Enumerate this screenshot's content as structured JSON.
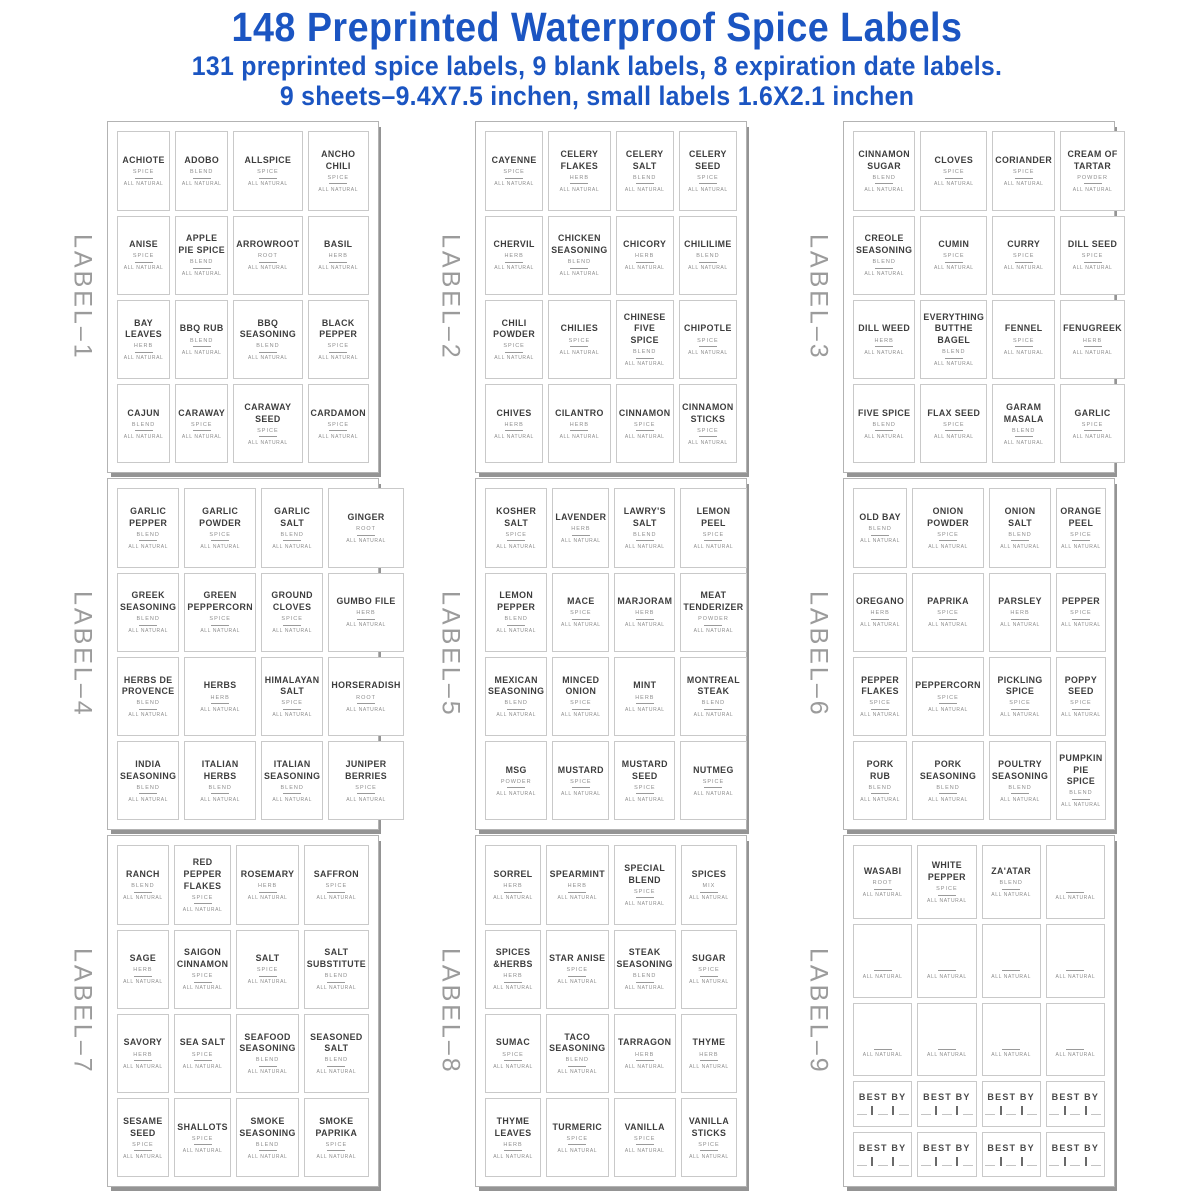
{
  "header": {
    "title": "148 Preprinted Waterproof Spice Labels",
    "subtitle1": "131 preprinted spice labels, 9 blank labels, 8 expiration date labels.",
    "subtitle2": "9 sheets–9.4X7.5 inchen, small labels 1.6X2.1 inchen"
  },
  "strings": {
    "all_natural": "ALL NATURAL",
    "best_by": "BEST BY"
  },
  "colors": {
    "accent_blue": "#1b55c2",
    "sheet_side_gray": "#9b9b9b",
    "label_border_gray": "#c9c9c9",
    "label_text_dark": "#3d3d3d",
    "label_text_gray": "#8d8d8d"
  },
  "sheets": [
    {
      "name": "LABEL–1",
      "labels": [
        {
          "name": "ACHIOTE",
          "type": "SPICE"
        },
        {
          "name": "ADOBO",
          "type": "BLEND"
        },
        {
          "name": "ALLSPICE",
          "type": "SPICE"
        },
        {
          "name": "ANCHO CHILI",
          "type": "SPICE"
        },
        {
          "name": "ANISE",
          "type": "SPICE"
        },
        {
          "name": "APPLE PIE SPICE",
          "type": "BLEND"
        },
        {
          "name": "ARROWROOT",
          "type": "ROOT"
        },
        {
          "name": "BASIL",
          "type": "HERB"
        },
        {
          "name": "BAY LEAVES",
          "type": "HERB"
        },
        {
          "name": "BBQ RUB",
          "type": "BLEND"
        },
        {
          "name": "BBQ SEASONING",
          "type": "BLEND"
        },
        {
          "name": "BLACK PEPPER",
          "type": "SPICE"
        },
        {
          "name": "CAJUN",
          "type": "BLEND"
        },
        {
          "name": "CARAWAY",
          "type": "SPICE"
        },
        {
          "name": "CARAWAY SEED",
          "type": "SPICE"
        },
        {
          "name": "CARDAMON",
          "type": "SPICE"
        }
      ]
    },
    {
      "name": "LABEL–2",
      "labels": [
        {
          "name": "CAYENNE",
          "type": "SPICE"
        },
        {
          "name": "CELERY FLAKES",
          "type": "HERB"
        },
        {
          "name": "CELERY SALT",
          "type": "BLEND"
        },
        {
          "name": "CELERY SEED",
          "type": "SPICE"
        },
        {
          "name": "CHERVIL",
          "type": "HERB"
        },
        {
          "name": "CHICKEN SEASONING",
          "type": "BLEND"
        },
        {
          "name": "CHICORY",
          "type": "HERB"
        },
        {
          "name": "CHILILIME",
          "type": "BLEND"
        },
        {
          "name": "CHILI POWDER",
          "type": "SPICE"
        },
        {
          "name": "CHILIES",
          "type": "SPICE"
        },
        {
          "name": "CHINESE FIVE SPICE",
          "type": "BLEND"
        },
        {
          "name": "CHIPOTLE",
          "type": "SPICE"
        },
        {
          "name": "CHIVES",
          "type": "HERB"
        },
        {
          "name": "CILANTRO",
          "type": "HERB"
        },
        {
          "name": "CINNAMON",
          "type": "SPICE"
        },
        {
          "name": "CINNAMON STICKS",
          "type": "SPICE"
        }
      ]
    },
    {
      "name": "LABEL–3",
      "labels": [
        {
          "name": "CINNAMON SUGAR",
          "type": "BLEND"
        },
        {
          "name": "CLOVES",
          "type": "SPICE"
        },
        {
          "name": "CORIANDER",
          "type": "SPICE"
        },
        {
          "name": "CREAM OF TARTAR",
          "type": "POWDER"
        },
        {
          "name": "CREOLE SEASONING",
          "type": "BLEND"
        },
        {
          "name": "CUMIN",
          "type": "SPICE"
        },
        {
          "name": "CURRY",
          "type": "SPICE"
        },
        {
          "name": "DILL SEED",
          "type": "SPICE"
        },
        {
          "name": "DILL WEED",
          "type": "HERB"
        },
        {
          "name": "EVERYTHING BUTTHE BAGEL",
          "type": "BLEND"
        },
        {
          "name": "FENNEL",
          "type": "SPICE"
        },
        {
          "name": "FENUGREEK",
          "type": "HERB"
        },
        {
          "name": "FIVE SPICE",
          "type": "BLEND"
        },
        {
          "name": "FLAX SEED",
          "type": "SPICE"
        },
        {
          "name": "GARAM MASALA",
          "type": "BLEND"
        },
        {
          "name": "GARLIC",
          "type": "SPICE"
        }
      ]
    },
    {
      "name": "LABEL–4",
      "labels": [
        {
          "name": "GARLIC PEPPER",
          "type": "BLEND"
        },
        {
          "name": "GARLIC POWDER",
          "type": "SPICE"
        },
        {
          "name": "GARLIC SALT",
          "type": "BLEND"
        },
        {
          "name": "GINGER",
          "type": "ROOT"
        },
        {
          "name": "GREEK SEASONING",
          "type": "BLEND"
        },
        {
          "name": "GREEN PEPPERCORN",
          "type": "SPICE"
        },
        {
          "name": "GROUND CLOVES",
          "type": "SPICE"
        },
        {
          "name": "GUMBO FILE",
          "type": "HERB"
        },
        {
          "name": "HERBS DE PROVENCE",
          "type": "BLEND"
        },
        {
          "name": "HERBS",
          "type": "HERB"
        },
        {
          "name": "HIMALAYAN SALT",
          "type": "SPICE"
        },
        {
          "name": "HORSERADISH",
          "type": "ROOT"
        },
        {
          "name": "INDIA SEASONING",
          "type": "BLEND"
        },
        {
          "name": "ITALIAN HERBS",
          "type": "BLEND"
        },
        {
          "name": "ITALIAN SEASONING",
          "type": "BLEND"
        },
        {
          "name": "JUNIPER BERRIES",
          "type": "SPICE"
        }
      ]
    },
    {
      "name": "LABEL–5",
      "labels": [
        {
          "name": "KOSHER SALT",
          "type": "SPICE"
        },
        {
          "name": "LAVENDER",
          "type": "HERB"
        },
        {
          "name": "LAWRY'S SALT",
          "type": "BLEND"
        },
        {
          "name": "LEMON PEEL",
          "type": "SPICE"
        },
        {
          "name": "LEMON PEPPER",
          "type": "BLEND"
        },
        {
          "name": "MACE",
          "type": "SPICE"
        },
        {
          "name": "MARJORAM",
          "type": "HERB"
        },
        {
          "name": "MEAT TENDERIZER",
          "type": "POWDER"
        },
        {
          "name": "MEXICAN SEASONING",
          "type": "BLEND"
        },
        {
          "name": "MINCED ONION",
          "type": "SPICE"
        },
        {
          "name": "MINT",
          "type": "HERB"
        },
        {
          "name": "MONTREAL STEAK",
          "type": "BLEND"
        },
        {
          "name": "MSG",
          "type": "POWDER"
        },
        {
          "name": "MUSTARD",
          "type": "SPICE"
        },
        {
          "name": "MUSTARD SEED",
          "type": "SPICE"
        },
        {
          "name": "NUTMEG",
          "type": "SPICE"
        }
      ]
    },
    {
      "name": "LABEL–6",
      "labels": [
        {
          "name": "OLD BAY",
          "type": "BLEND"
        },
        {
          "name": "ONION POWDER",
          "type": "SPICE"
        },
        {
          "name": "ONION SALT",
          "type": "BLEND"
        },
        {
          "name": "ORANGE PEEL",
          "type": "SPICE"
        },
        {
          "name": "OREGANO",
          "type": "HERB"
        },
        {
          "name": "PAPRIKA",
          "type": "SPICE"
        },
        {
          "name": "PARSLEY",
          "type": "HERB"
        },
        {
          "name": "PEPPER",
          "type": "SPICE"
        },
        {
          "name": "PEPPER FLAKES",
          "type": "SPICE"
        },
        {
          "name": "PEPPERCORN",
          "type": "SPICE"
        },
        {
          "name": "PICKLING SPICE",
          "type": "SPICE"
        },
        {
          "name": "POPPY SEED",
          "type": "SPICE"
        },
        {
          "name": "PORK RUB",
          "type": "BLEND"
        },
        {
          "name": "PORK SEASONING",
          "type": "BLEND"
        },
        {
          "name": "POULTRY SEASONING",
          "type": "BLEND"
        },
        {
          "name": "PUMPKIN PIE SPICE",
          "type": "BLEND"
        }
      ]
    },
    {
      "name": "LABEL–7",
      "labels": [
        {
          "name": "RANCH",
          "type": "BLEND"
        },
        {
          "name": "RED PEPPER FLAKES",
          "type": "SPICE"
        },
        {
          "name": "ROSEMARY",
          "type": "HERB"
        },
        {
          "name": "SAFFRON",
          "type": "SPICE"
        },
        {
          "name": "SAGE",
          "type": "HERB"
        },
        {
          "name": "SAIGON CINNAMON",
          "type": "SPICE"
        },
        {
          "name": "SALT",
          "type": "SPICE"
        },
        {
          "name": "SALT SUBSTITUTE",
          "type": "BLEND"
        },
        {
          "name": "SAVORY",
          "type": "HERB"
        },
        {
          "name": "SEA SALT",
          "type": "SPICE"
        },
        {
          "name": "SEAFOOD SEASONING",
          "type": "BLEND"
        },
        {
          "name": "SEASONED SALT",
          "type": "BLEND"
        },
        {
          "name": "SESAME SEED",
          "type": "SPICE"
        },
        {
          "name": "SHALLOTS",
          "type": "SPICE"
        },
        {
          "name": "SMOKE SEASONING",
          "type": "BLEND"
        },
        {
          "name": "SMOKE PAPRIKA",
          "type": "SPICE"
        }
      ]
    },
    {
      "name": "LABEL–8",
      "labels": [
        {
          "name": "SORREL",
          "type": "HERB"
        },
        {
          "name": "SPEARMINT",
          "type": "HERB"
        },
        {
          "name": "SPECIAL BLEND",
          "type": "SPICE"
        },
        {
          "name": "SPICES",
          "type": "MIX"
        },
        {
          "name": "SPICES &HERBS",
          "type": "HERB"
        },
        {
          "name": "STAR ANISE",
          "type": "SPICE"
        },
        {
          "name": "STEAK SEASONING",
          "type": "BLEND"
        },
        {
          "name": "SUGAR",
          "type": "SPICE"
        },
        {
          "name": "SUMAC",
          "type": "SPICE"
        },
        {
          "name": "TACO SEASONING",
          "type": "BLEND"
        },
        {
          "name": "TARRAGON",
          "type": "HERB"
        },
        {
          "name": "THYME",
          "type": "HERB"
        },
        {
          "name": "THYME LEAVES",
          "type": "HERB"
        },
        {
          "name": "TURMERIC",
          "type": "SPICE"
        },
        {
          "name": "VANILLA",
          "type": "SPICE"
        },
        {
          "name": "VANILLA STICKS",
          "type": "SPICE"
        }
      ]
    },
    {
      "name": "LABEL–9",
      "best_by_count": 8,
      "labels": [
        {
          "name": "WASABI",
          "type": "ROOT"
        },
        {
          "name": "WHITE PEPPER",
          "type": "SPICE"
        },
        {
          "name": "ZA'ATAR",
          "type": "BLEND"
        },
        {
          "blank": true
        },
        {
          "blank": true
        },
        {
          "blank": true
        },
        {
          "blank": true
        },
        {
          "blank": true
        },
        {
          "blank": true
        },
        {
          "blank": true
        },
        {
          "blank": true
        },
        {
          "blank": true
        }
      ]
    }
  ]
}
